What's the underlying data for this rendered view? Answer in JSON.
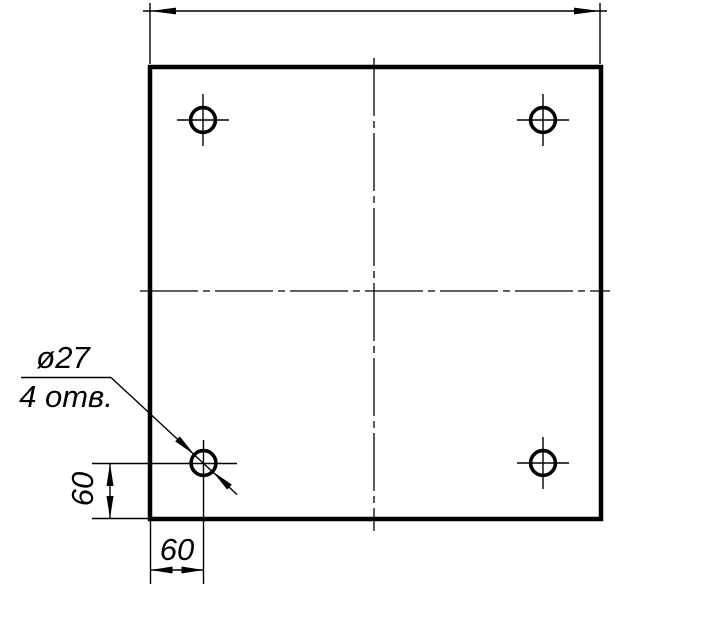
{
  "drawing": {
    "kind": "engineering-drawing",
    "subject": "square plate with four drilled holes",
    "background_color": "#ffffff",
    "line_color": "#000000",
    "labels": {
      "hole_diameter": "ø27",
      "hole_count": "4 отв.",
      "vertical_offset_dim": "60",
      "horizontal_offset_dim": "60"
    },
    "values": {
      "hole_diameter": 27,
      "hole_count": 4,
      "hole_offset_from_left_edge": 60,
      "hole_offset_from_bottom_edge": 60
    }
  }
}
